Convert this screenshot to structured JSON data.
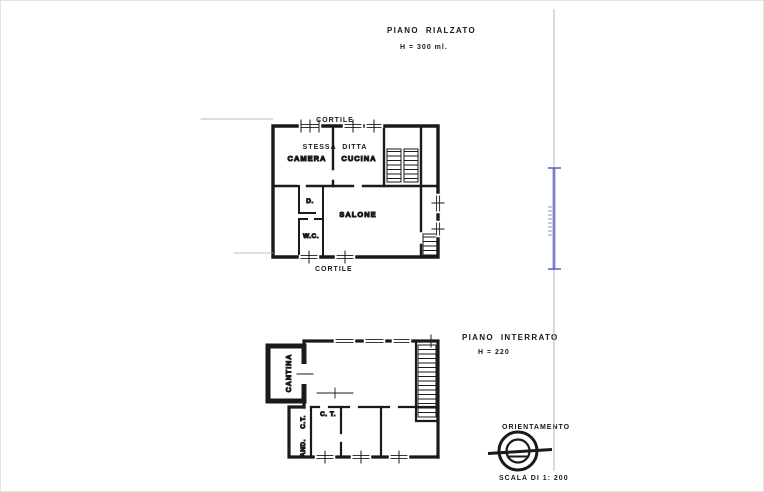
{
  "sheet": {
    "upper": {
      "title": "PIANO  RIALZATO",
      "height_note": "H = 300 ml.",
      "cortile_top_line1": "CORTILE",
      "cortile_top_line2": "STESSA  DITTA",
      "cortile_bottom": "CORTILE",
      "rooms": {
        "camera": "CAMERA",
        "cucina": "CUCINA",
        "disimpegno": "D.",
        "salone": "SALONE",
        "wc": "W.C."
      }
    },
    "lower": {
      "title": "PIANO  INTERRATO",
      "height_note": "H = 220",
      "rooms": {
        "cantina": "CANTINA",
        "ct_vertical": "C.T.",
        "androne": "AND.",
        "ct_room": "C. T."
      }
    },
    "footer": {
      "orientation_label": "ORIENTAMENTO",
      "scale_label": "SCALA DI 1: 200"
    },
    "colors": {
      "ink": "#1a1a1a",
      "boundary_blue": "#7d80cf",
      "faint_gray": "#b5b5bd"
    }
  }
}
